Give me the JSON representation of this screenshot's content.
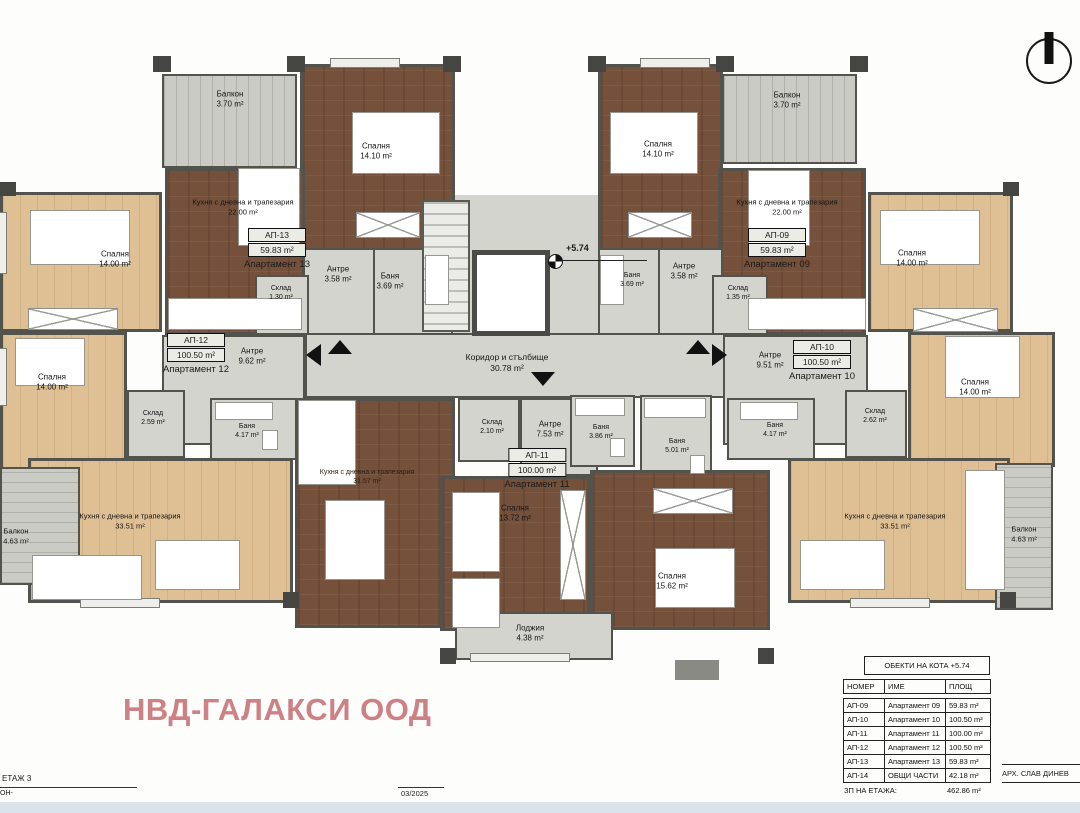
{
  "watermark": "НВД-ГАЛАКСИ ООД",
  "north_icon": "north-orientation-symbol",
  "center": {
    "corridor_name": "Коридор и стълбище",
    "corridor_area": "30.78 m²",
    "level_mark": "+5.74"
  },
  "apartments": {
    "ap13": {
      "id": "АП-13",
      "area": "59.83 m²",
      "name": "Апартамент 13",
      "rooms": {
        "balcony": {
          "name": "Балкон",
          "area": "3.70 m²"
        },
        "bedroom": {
          "name": "Спалня",
          "area": "14.10 m²"
        },
        "kitchen": {
          "name": "Кухня с дневна и трапезария",
          "area": "22.00 m²"
        },
        "storage": {
          "name": "Склад",
          "area": "1.30 m²"
        },
        "hall": {
          "name": "Антре",
          "area": "3.58 m²"
        },
        "bath": {
          "name": "Баня",
          "area": "3.69 m²"
        }
      }
    },
    "ap12": {
      "id": "АП-12",
      "area": "100.50 m²",
      "name": "Апартамент 12",
      "rooms": {
        "bedroom1": {
          "name": "Спалня",
          "area": "14.00 m²"
        },
        "bedroom2": {
          "name": "Спалня",
          "area": "14.00 m²"
        },
        "storage": {
          "name": "Склад",
          "area": "2.59 m²"
        },
        "hall": {
          "name": "Антре",
          "area": "9.62 m²"
        },
        "bath": {
          "name": "Баня",
          "area": "4.17 m²"
        },
        "kitchen": {
          "name": "Кухня с дневна и трапезария",
          "area": "33.51 m²"
        },
        "balcony": {
          "name": "Балкон",
          "area": "4.63 m²"
        }
      }
    },
    "ap11": {
      "id": "АП-11",
      "area": "100.00 m²",
      "name": "Апартамент 11",
      "rooms": {
        "kitchen": {
          "name": "Кухня с дневна и трапезария",
          "area": "31.57 m²"
        },
        "storage": {
          "name": "Склад",
          "area": "2.10 m²"
        },
        "hall": {
          "name": "Антре",
          "area": "7.53 m²"
        },
        "bath1": {
          "name": "Баня",
          "area": "3.86 m²"
        },
        "bath2": {
          "name": "Баня",
          "area": "5.01 m²"
        },
        "bedroom1": {
          "name": "Спалня",
          "area": "13.72 m²"
        },
        "bedroom2": {
          "name": "Спалня",
          "area": "15.62 m²"
        },
        "loggia": {
          "name": "Лоджия",
          "area": "4.38 m²"
        }
      }
    },
    "ap09": {
      "id": "АП-09",
      "area": "59.83 m²",
      "name": "Апартамент 09",
      "rooms": {
        "balcony": {
          "name": "Балкон",
          "area": "3.70 m²"
        },
        "bedroom": {
          "name": "Спалня",
          "area": "14.10 m²"
        },
        "kitchen": {
          "name": "Кухня с дневна и трапезария",
          "area": "22.00 m²"
        },
        "hall": {
          "name": "Антре",
          "area": "3.58 m²"
        },
        "bath": {
          "name": "Баня",
          "area": "3.69 m²"
        },
        "storage": {
          "name": "Склад",
          "area": "1.35 m²"
        }
      }
    },
    "ap10": {
      "id": "АП-10",
      "area": "100.50 m²",
      "name": "Апартамент 10",
      "rooms": {
        "bedroom1": {
          "name": "Спалня",
          "area": "14.00 m²"
        },
        "bedroom2": {
          "name": "Спалня",
          "area": "14.00 m²"
        },
        "storage": {
          "name": "Склад",
          "area": "2.62 m²"
        },
        "hall": {
          "name": "Антре",
          "area": "9.51 m²"
        },
        "bath": {
          "name": "Баня",
          "area": "4.17 m²"
        },
        "kitchen": {
          "name": "Кухня с дневна и трапезария",
          "area": "33.51 m²"
        },
        "balcony": {
          "name": "Балкон",
          "area": "4.63 m²"
        }
      }
    }
  },
  "schedule": {
    "title": "ОБЕКТИ НА КОТА +5.74",
    "columns": [
      "НОМЕР",
      "ИМЕ",
      "ПЛОЩ"
    ],
    "rows": [
      [
        "АП-09",
        "Апартамент 09",
        "59.83 m²"
      ],
      [
        "АП-10",
        "Апартамент 10",
        "100.50 m²"
      ],
      [
        "АП-11",
        "Апартамент 11",
        "100.00 m²"
      ],
      [
        "АП-12",
        "Апартамент 12",
        "100.50 m²"
      ],
      [
        "АП-13",
        "Апартамент 13",
        "59.83 m²"
      ],
      [
        "АП-14",
        "ОБЩИ ЧАСТИ",
        "42.18 m²"
      ]
    ],
    "total_label": "ЗП НА ЕТАЖА:",
    "total_value": "462.86 m²"
  },
  "footer": {
    "floor_label": "ЕТАЖ 3",
    "floor_code": "ОН-",
    "date": "03/2025",
    "architect": "АРХ. СЛАВ ДИНЕВ"
  },
  "colors": {
    "wall": "#4c4c47",
    "wood_dark": "#75513b",
    "wood_light": "#dfc094",
    "floor_gray": "#d4d4cf",
    "balcony": "#cbcbc6",
    "watermark": "#ce8185"
  }
}
